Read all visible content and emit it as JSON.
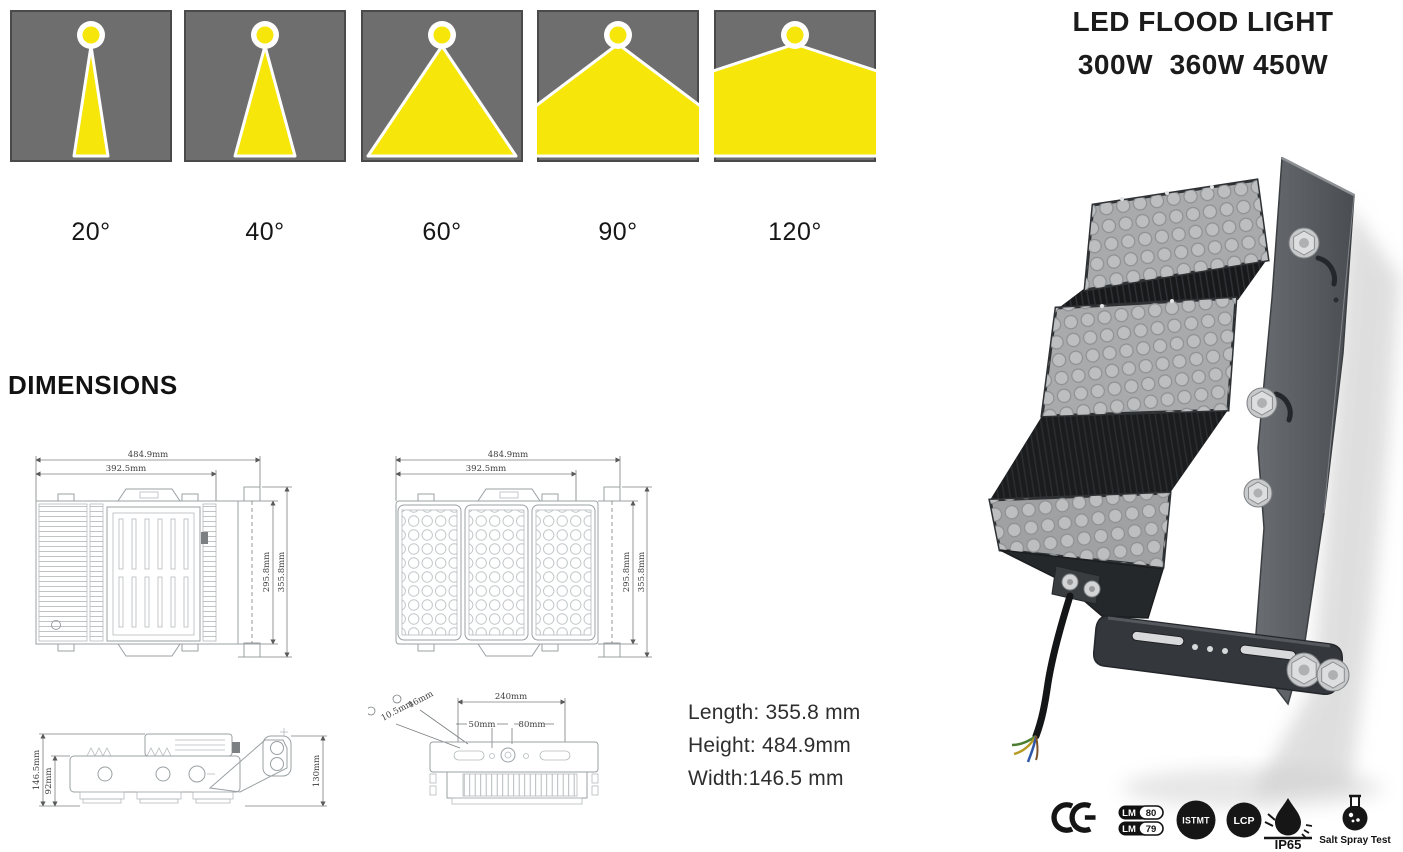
{
  "header": {
    "title": "LED FLOOD LIGHT",
    "wattages": "300W  360W 450W"
  },
  "beam_angles": {
    "labels": [
      "20°",
      "40°",
      "60°",
      "90°",
      "120°"
    ]
  },
  "dimensions": {
    "heading": "DIMENSIONS",
    "back_view": {
      "outer_width": "484.9mm",
      "inner_width": "392.5mm",
      "inner_height": "295.8mm",
      "outer_height": "355.8mm"
    },
    "front_view": {
      "outer_width": "484.9mm",
      "inner_width": "392.5mm",
      "inner_height": "295.8mm",
      "outer_height": "355.8mm"
    },
    "side_view": {
      "outer_height": "146.5mm",
      "body_height": "92mm",
      "bracket_depth": "130mm"
    },
    "bottom_view": {
      "slot_length": "16mm",
      "slot_width": "10.5mm",
      "mount_spacing": "240mm",
      "offset_left": "50mm",
      "offset_right": "80mm"
    }
  },
  "specs": {
    "length": "Length: 355.8 mm",
    "height": "Height: 484.9mm",
    "width": "Width:146.5 mm"
  },
  "certifications": {
    "ce": "CE",
    "lm80": {
      "label": "LM",
      "value": "80"
    },
    "lm79": {
      "label": "LM",
      "value": "79"
    },
    "istmt": "ISTMT",
    "lcp": "LCP",
    "ip65": "IP65",
    "salt_spray": "Salt Spray Test"
  },
  "colors": {
    "beam_yellow": "#F6E60A",
    "beam_gray": "#6E6E6E",
    "cert_black": "#161616",
    "fixture_dark_gray": "#4a4d51",
    "module_gray": "#a8aaac"
  }
}
